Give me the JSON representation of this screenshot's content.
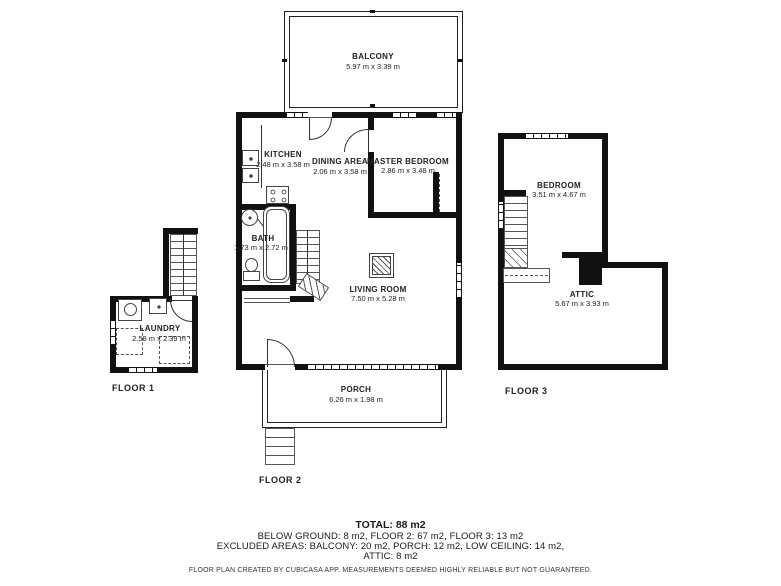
{
  "rooms": {
    "balcony": {
      "name": "BALCONY",
      "dims": "5.97 m x 3.39 m"
    },
    "kitchen": {
      "name": "KITCHEN",
      "dims": "2.48 m x 3.58 m"
    },
    "dining_area": {
      "name": "DINING AREA",
      "dims": "2.06 m x 3.58 m"
    },
    "master_bedroom": {
      "name": "MASTER BEDROOM",
      "dims": "2.86 m x 3.48 m"
    },
    "bath": {
      "name": "BATH",
      "dims": "1.73 m x 2.72 m"
    },
    "living_room": {
      "name": "LIVING ROOM",
      "dims": "7.50 m x 5.28 m"
    },
    "porch": {
      "name": "PORCH",
      "dims": "6.26 m x 1.98 m"
    },
    "laundry": {
      "name": "LAUNDRY",
      "dims": "2.58 m x 2.39 m"
    },
    "bedroom": {
      "name": "BEDROOM",
      "dims": "3.51 m x 4.67 m"
    },
    "attic": {
      "name": "ATTIC",
      "dims": "5.67 m x 3.93 m"
    }
  },
  "floor_labels": {
    "floor1": "FLOOR 1",
    "floor2": "FLOOR 2",
    "floor3": "FLOOR 3"
  },
  "summary": {
    "total": "TOTAL: 88 m2",
    "areas_line": "BELOW GROUND: 8 m2, FLOOR 2: 67 m2, FLOOR 3: 13 m2",
    "excluded_line1": "EXCLUDED AREAS: BALCONY: 20 m2, PORCH: 12 m2, LOW CEILING: 14 m2,",
    "excluded_line2": "ATTIC: 8 m2",
    "disclaimer": "FLOOR PLAN CREATED BY CUBICASA APP. MEASUREMENTS DEEMED HIGHLY RELIABLE BUT NOT GUARANTEED."
  },
  "colors": {
    "wall": "#111111",
    "background": "#ffffff",
    "text": "#1a1a1a"
  }
}
